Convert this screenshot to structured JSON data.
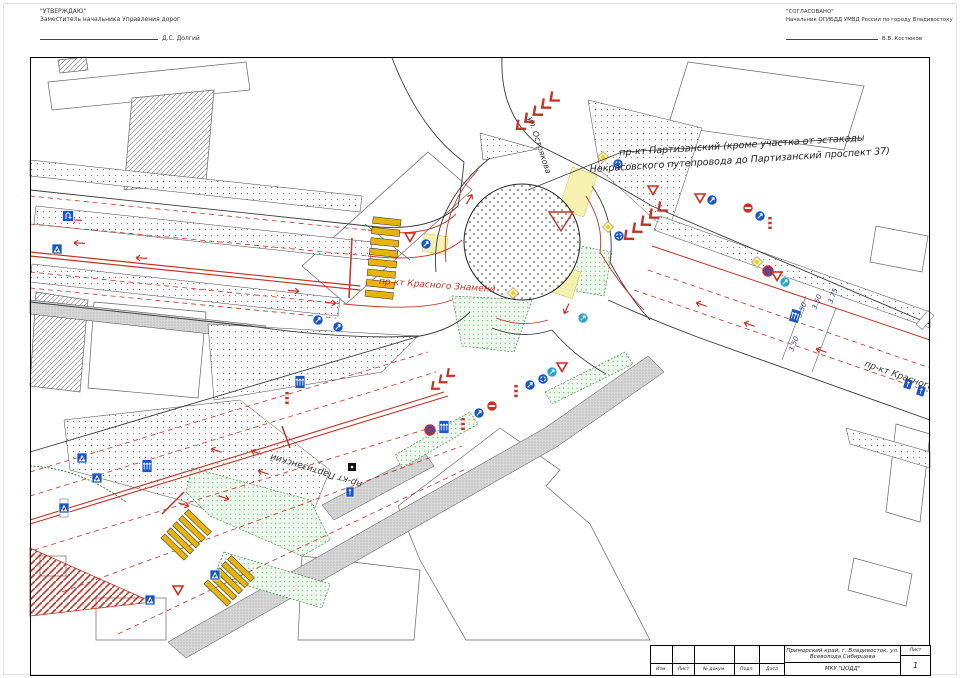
{
  "approvals": {
    "left": {
      "stamp": "\"УТВЕРЖДАЮ\"",
      "role": "Заместитель начальника Управления дорог",
      "signee": "Д.С. Долгий"
    },
    "right": {
      "stamp": "\"СОГЛАСОВАНО\"",
      "role": "Начальник ОГИБДД УМВД России по городу Владивостоку",
      "signee": "В.В. Костюков"
    }
  },
  "map": {
    "note": {
      "line1": "пр-кт Партизанский (кроме участка от эстакады",
      "line2": "Некрасовского путепровода до Партизанский проспект 37)"
    },
    "streets": {
      "krasnogo_west": "пр-кт Красного Знамени",
      "krasnogo_east": "пр-кт Красного Знамени",
      "partizansky": "пр-кт Партизанский",
      "ostryakova": "ул. Острякова"
    },
    "dimensions": {
      "d1": "3.50",
      "d2": "3.50",
      "d3": "3.75",
      "d4": "3.50"
    },
    "sign_types": [
      "yield",
      "roundabout",
      "keep-right",
      "no-entry",
      "pedestrian-crossing",
      "priority-road",
      "lane-directions",
      "u-turn-area",
      "no-stopping",
      "detour"
    ]
  },
  "title_block": {
    "location": "Приморский край, г. Владивосток, ул. Всеволода Сибирцева",
    "org": "МКУ \"ЦОДД\"",
    "sheet_label": "Лист",
    "sheet_value": "1",
    "cols": {
      "izm": "Изм.",
      "list": "Лист",
      "doc": "№ докум.",
      "podp": "Подп.",
      "data": "Дата"
    }
  },
  "colors": {
    "marking_red": "#c33327",
    "zebra_yellow": "#e6b40c",
    "sign_blue": "#1656c8",
    "no_entry_red": "#d52b1e",
    "island_green": "#4aa84a",
    "pale_yellow": "#f5f0a8"
  }
}
